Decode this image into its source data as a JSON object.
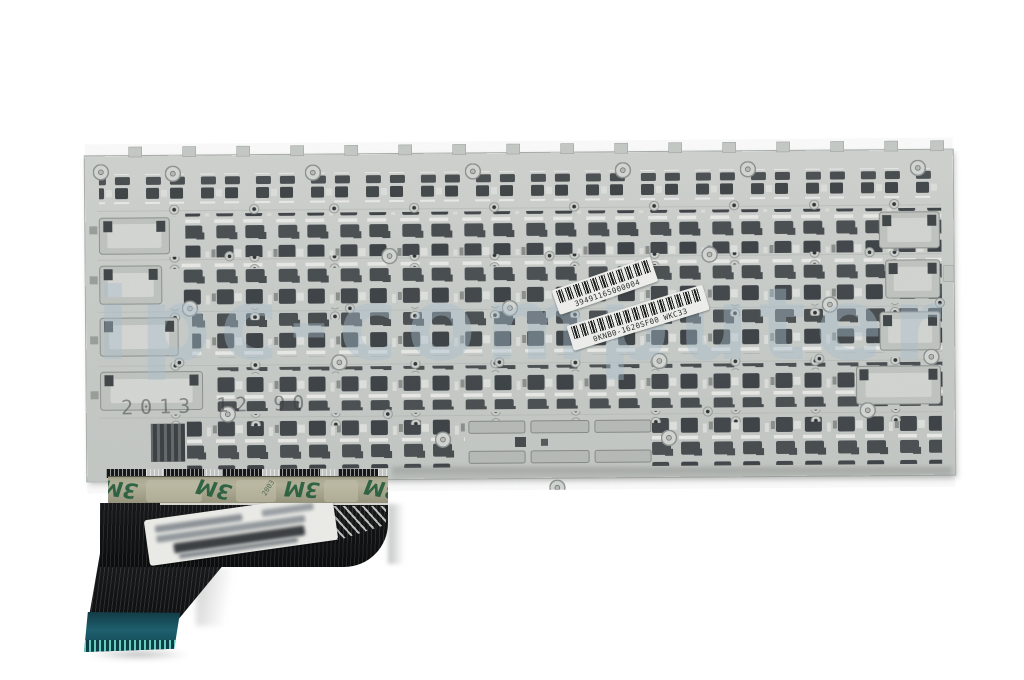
{
  "photo": {
    "alt": "Rear metal backplate of a laptop replacement keyboard with scissor-mount cutouts, two barcode stickers, 3M adhesive tape strip and a black ribbon cable with teal connector",
    "watermark": "ipc-computer",
    "plate_stamp": "2013 12 90",
    "labels": {
      "serial": "39491165000004",
      "part_number": "0KNB0-1620SF00 WKC33"
    },
    "tape": {
      "brand": "3M",
      "print": "2003"
    },
    "colors": {
      "background": "#ffffff",
      "plate": "#cbcfcc",
      "cutout_dark": "#41464a",
      "tape_olive": "#a5a38b",
      "tape_logo_green": "#235c3c",
      "ribbon_black": "#101112",
      "connector_teal": "#1e5f6e",
      "contact_cyan": "#67cdbd",
      "watermark_blue": "#a9becd"
    }
  }
}
